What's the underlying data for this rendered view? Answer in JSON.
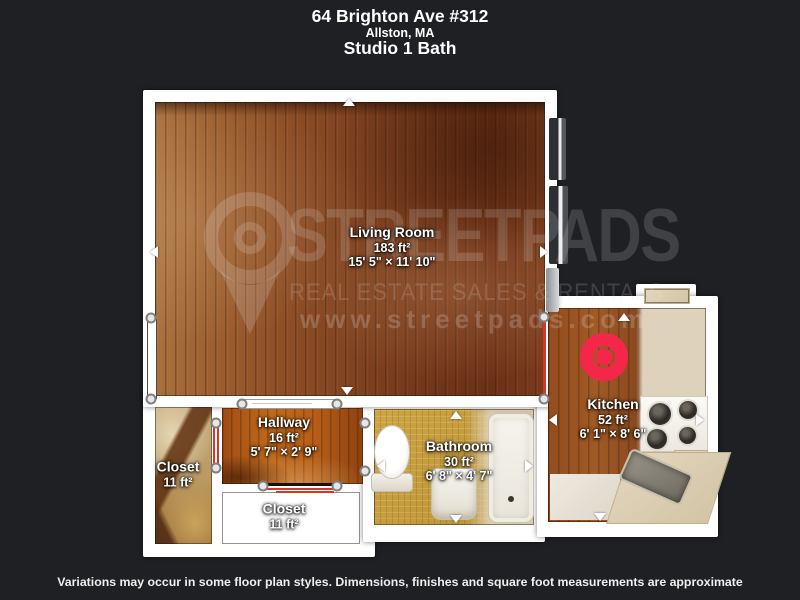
{
  "header": {
    "address": "64 Brighton Ave #312",
    "city": "Allston, MA",
    "unit_type": "Studio 1 Bath"
  },
  "footer": {
    "disclaimer": "Variations may occur in some floor plan styles. Dimensions, finishes and square foot measurements are approximate"
  },
  "watermark": {
    "brand": "STREETPADS",
    "tagline": "REAL ESTATE SALES & RENTALS",
    "url": "www.streetpads.com"
  },
  "rooms": {
    "living_room": {
      "name": "Living Room",
      "area": "183 ft²",
      "dims": "15' 5\" × 11' 10\""
    },
    "hallway": {
      "name": "Hallway",
      "area": "16 ft²",
      "dims": "5' 7\" × 2' 9\""
    },
    "closet_left": {
      "name": "Closet",
      "area": "11 ft²",
      "dims": ""
    },
    "closet_bottom": {
      "name": "Closet",
      "area": "11 ft²",
      "dims": ""
    },
    "bathroom": {
      "name": "Bathroom",
      "area": "30 ft²",
      "dims": "6' 8\" × 4' 7\""
    },
    "kitchen": {
      "name": "Kitchen",
      "area": "52 ft²",
      "dims": "6' 1\" × 8' 6\""
    }
  },
  "colors": {
    "background": "#1e2023",
    "walls": "#ffffff",
    "door_marker": "#d5352b",
    "camera_marker": "#f4274b"
  }
}
